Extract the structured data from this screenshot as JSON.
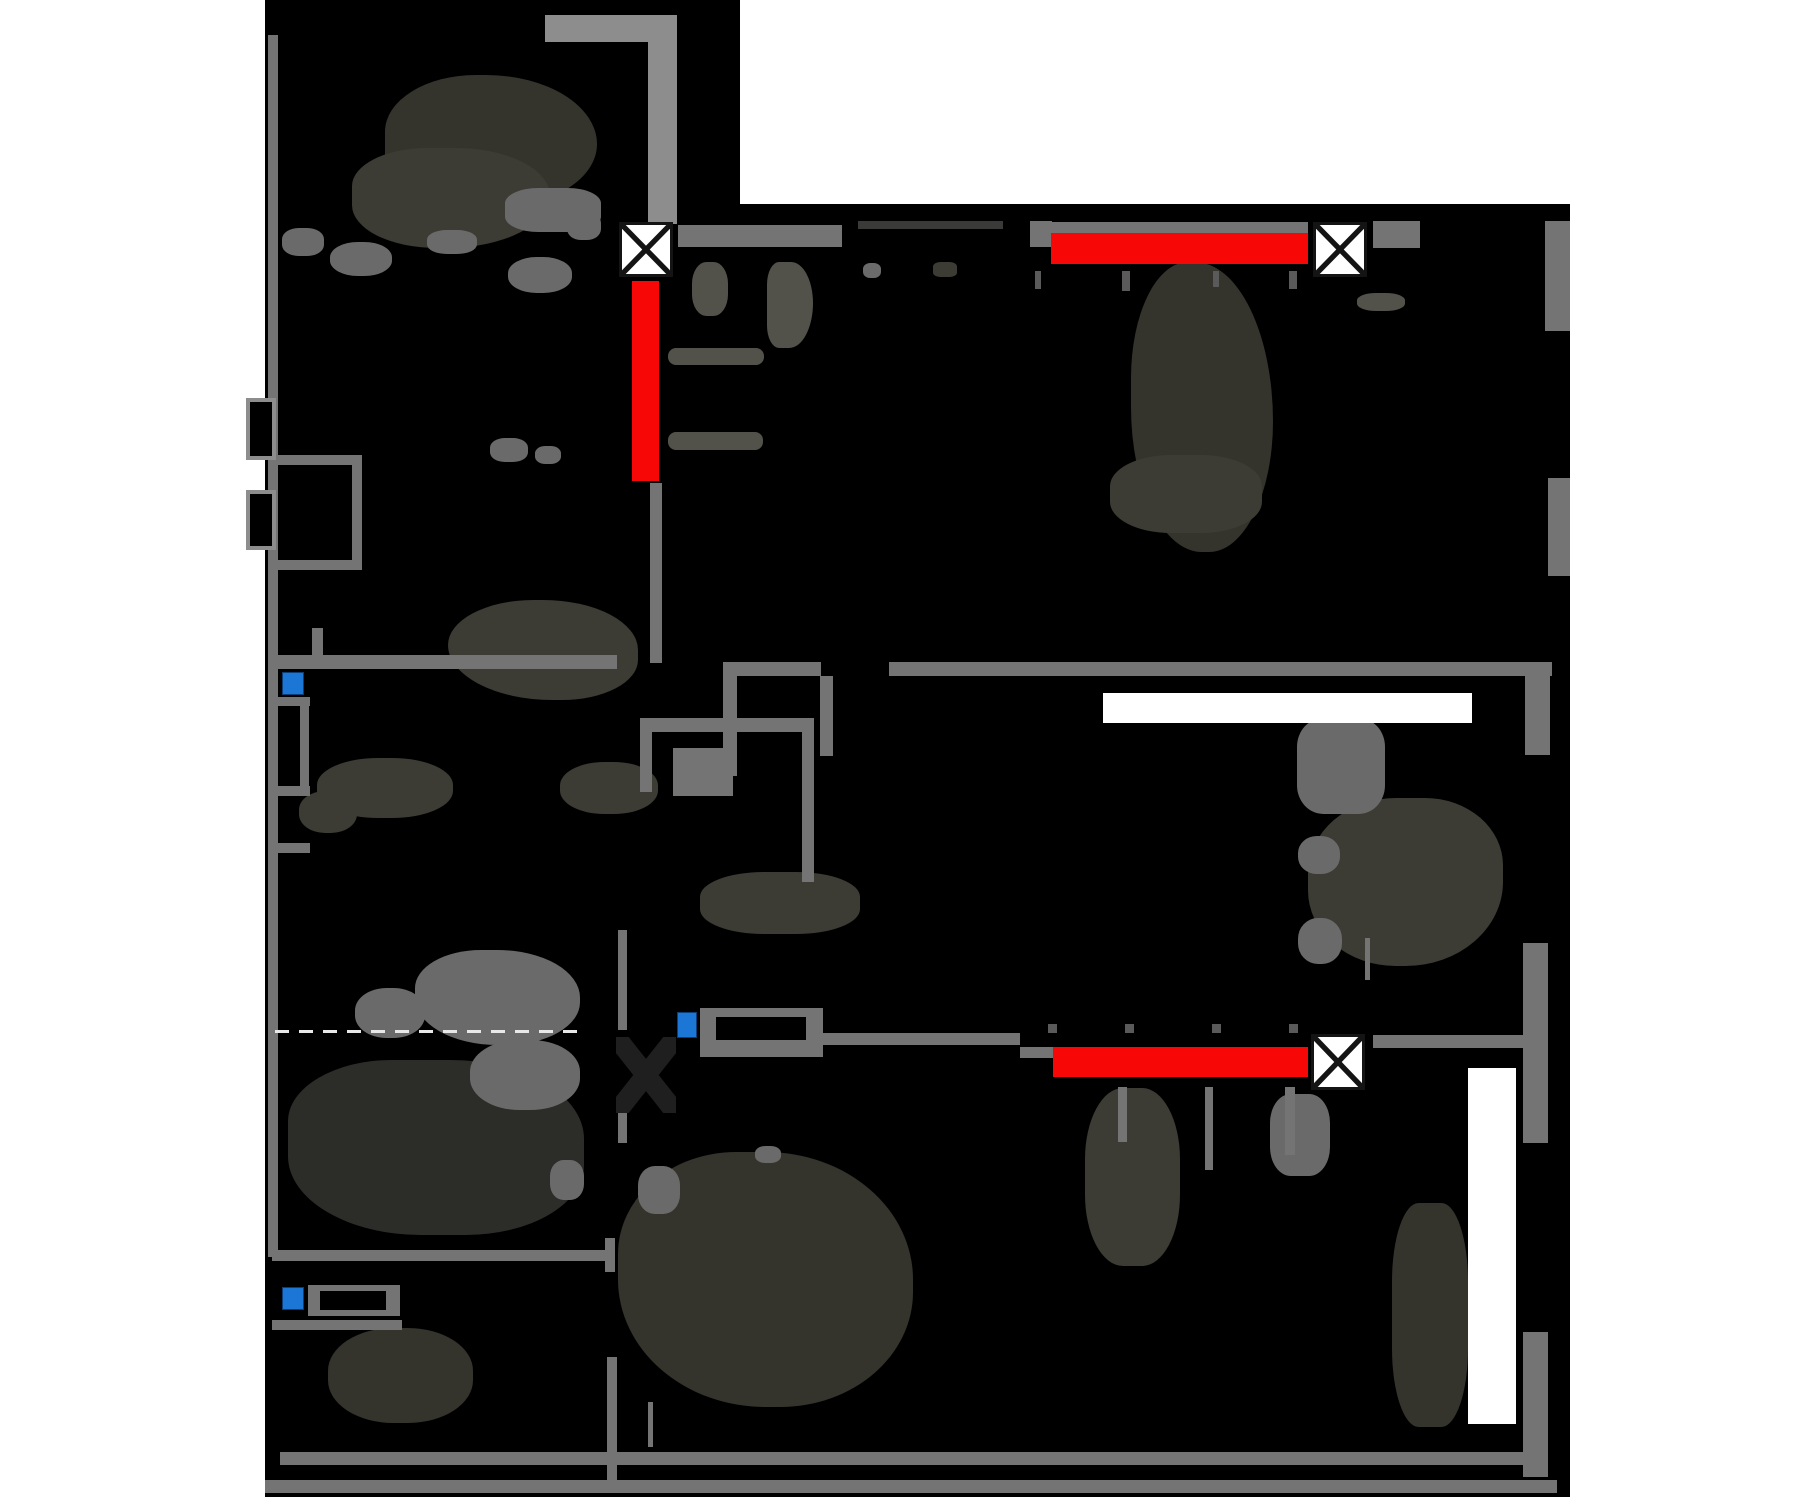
{
  "meta": {
    "width": 1800,
    "height": 1500,
    "background": "#ffffff",
    "plan_background": "#000000"
  },
  "labels": {
    "apartment_type": "3-комн."
  },
  "label_pos": {
    "x": 330,
    "y": 1122,
    "w": 200,
    "size": 36
  },
  "colors": {
    "wall": "#747474",
    "wall_light": "#8d8d8d",
    "wall_dark": "#3a3a38",
    "highlight_red": "#f80707",
    "highlight_white": "#ffffff",
    "marker_blue": "#1b76d6",
    "marker_blue_border": "#0b3e77",
    "vent_fill": "#ffffff",
    "vent_stroke": "#141414",
    "tick": "#5a5a5a",
    "dash": "#e8e8e8",
    "blob_dark1": "#2c2c28",
    "blob_dark2": "#34342d",
    "blob_dark3": "#3c3c34",
    "blob_mid": "#52524a",
    "blob_gray": "#6a6a6a"
  },
  "silhouette": [
    {
      "x": 265,
      "y": 0,
      "w": 475,
      "h": 1497
    },
    {
      "x": 738,
      "y": 204,
      "w": 832,
      "h": 1293
    }
  ],
  "walls": [
    {
      "x": 545,
      "y": 15,
      "w": 132,
      "h": 27,
      "c": "light"
    },
    {
      "x": 648,
      "y": 15,
      "w": 29,
      "h": 209,
      "c": "light"
    },
    {
      "x": 678,
      "y": 225,
      "w": 164,
      "h": 22
    },
    {
      "x": 858,
      "y": 221,
      "w": 145,
      "h": 8,
      "c": "dark"
    },
    {
      "x": 1030,
      "y": 221,
      "w": 22,
      "h": 26
    },
    {
      "x": 1035,
      "y": 222,
      "w": 273,
      "h": 11
    },
    {
      "x": 1373,
      "y": 221,
      "w": 47,
      "h": 27
    },
    {
      "x": 1545,
      "y": 221,
      "w": 25,
      "h": 110
    },
    {
      "x": 1548,
      "y": 478,
      "w": 22,
      "h": 98
    },
    {
      "x": 723,
      "y": 662,
      "w": 98,
      "h": 14
    },
    {
      "x": 889,
      "y": 662,
      "w": 663,
      "h": 14
    },
    {
      "x": 1525,
      "y": 662,
      "w": 25,
      "h": 93
    },
    {
      "x": 272,
      "y": 655,
      "w": 345,
      "h": 14
    },
    {
      "x": 268,
      "y": 35,
      "w": 10,
      "h": 1222
    },
    {
      "x": 650,
      "y": 483,
      "w": 12,
      "h": 180
    },
    {
      "x": 723,
      "y": 676,
      "w": 14,
      "h": 100
    },
    {
      "x": 820,
      "y": 676,
      "w": 13,
      "h": 80
    },
    {
      "x": 640,
      "y": 718,
      "w": 174,
      "h": 14
    },
    {
      "x": 802,
      "y": 732,
      "w": 12,
      "h": 150
    },
    {
      "x": 640,
      "y": 732,
      "w": 12,
      "h": 60
    },
    {
      "x": 618,
      "y": 930,
      "w": 9,
      "h": 100
    },
    {
      "x": 618,
      "y": 1098,
      "w": 9,
      "h": 45
    },
    {
      "x": 823,
      "y": 1033,
      "w": 197,
      "h": 12
    },
    {
      "x": 1020,
      "y": 1047,
      "w": 33,
      "h": 11
    },
    {
      "x": 1373,
      "y": 1035,
      "w": 150,
      "h": 13
    },
    {
      "x": 1523,
      "y": 943,
      "w": 25,
      "h": 200
    },
    {
      "x": 1523,
      "y": 1332,
      "w": 25,
      "h": 145
    },
    {
      "x": 1118,
      "y": 1087,
      "w": 9,
      "h": 55
    },
    {
      "x": 1205,
      "y": 1087,
      "w": 8,
      "h": 83
    },
    {
      "x": 1285,
      "y": 1087,
      "w": 10,
      "h": 68
    },
    {
      "x": 272,
      "y": 1250,
      "w": 335,
      "h": 11
    },
    {
      "x": 605,
      "y": 1238,
      "w": 10,
      "h": 34
    },
    {
      "x": 607,
      "y": 1357,
      "w": 10,
      "h": 133
    },
    {
      "x": 280,
      "y": 1452,
      "w": 1243,
      "h": 13
    },
    {
      "x": 265,
      "y": 1480,
      "w": 1292,
      "h": 13
    },
    {
      "x": 272,
      "y": 455,
      "w": 88,
      "h": 10
    },
    {
      "x": 272,
      "y": 560,
      "w": 88,
      "h": 10
    },
    {
      "x": 352,
      "y": 455,
      "w": 10,
      "h": 115
    },
    {
      "x": 272,
      "y": 1320,
      "w": 130,
      "h": 10
    },
    {
      "x": 312,
      "y": 628,
      "w": 11,
      "h": 30
    },
    {
      "x": 648,
      "y": 1402,
      "w": 5,
      "h": 45
    },
    {
      "x": 1365,
      "y": 938,
      "w": 5,
      "h": 42
    },
    {
      "x": 673,
      "y": 748,
      "w": 60,
      "h": 48
    },
    {
      "x": 270,
      "y": 697,
      "w": 40,
      "h": 9
    },
    {
      "x": 300,
      "y": 706,
      "w": 9,
      "h": 90
    },
    {
      "x": 272,
      "y": 786,
      "w": 38,
      "h": 10
    },
    {
      "x": 272,
      "y": 843,
      "w": 38,
      "h": 10
    }
  ],
  "shaft_boxes": [
    {
      "x": 246,
      "y": 398,
      "w": 30,
      "h": 62
    },
    {
      "x": 246,
      "y": 490,
      "w": 30,
      "h": 60
    }
  ],
  "red_bars": [
    {
      "x": 632,
      "y": 281,
      "w": 27,
      "h": 200
    },
    {
      "x": 1051,
      "y": 233,
      "w": 257,
      "h": 31
    },
    {
      "x": 1053,
      "y": 1047,
      "w": 255,
      "h": 30
    }
  ],
  "white_bars": [
    {
      "x": 1103,
      "y": 693,
      "w": 369,
      "h": 30
    },
    {
      "x": 1468,
      "y": 1068,
      "w": 48,
      "h": 356
    }
  ],
  "vent_boxes": [
    {
      "x": 619,
      "y": 222,
      "w": 54,
      "h": 55
    },
    {
      "x": 1313,
      "y": 222,
      "w": 54,
      "h": 55
    },
    {
      "x": 1311,
      "y": 1034,
      "w": 54,
      "h": 56
    }
  ],
  "dark_cross": {
    "x": 616,
    "y": 1037,
    "w": 60,
    "h": 76
  },
  "blue_markers": [
    {
      "x": 282,
      "y": 672,
      "w": 22,
      "h": 23
    },
    {
      "x": 677,
      "y": 1012,
      "w": 20,
      "h": 26
    },
    {
      "x": 282,
      "y": 1287,
      "w": 22,
      "h": 23
    }
  ],
  "counters": [
    {
      "x": 700,
      "y": 1008,
      "w": 123,
      "h": 49,
      "ix": 16,
      "iy": 9,
      "iw": 90,
      "ih": 23
    },
    {
      "x": 308,
      "y": 1285,
      "w": 92,
      "h": 31,
      "ix": 12,
      "iy": 6,
      "iw": 66,
      "ih": 19
    }
  ],
  "ticks": [
    {
      "x": 1035,
      "y": 271,
      "w": 6,
      "h": 18
    },
    {
      "x": 1122,
      "y": 271,
      "w": 8,
      "h": 20
    },
    {
      "x": 1213,
      "y": 271,
      "w": 6,
      "h": 16
    },
    {
      "x": 1289,
      "y": 271,
      "w": 8,
      "h": 18
    },
    {
      "x": 1048,
      "y": 1024,
      "w": 9,
      "h": 9
    },
    {
      "x": 1125,
      "y": 1024,
      "w": 9,
      "h": 9
    },
    {
      "x": 1212,
      "y": 1024,
      "w": 9,
      "h": 9
    },
    {
      "x": 1289,
      "y": 1024,
      "w": 9,
      "h": 9
    }
  ],
  "dashed_line": {
    "x": 275,
    "y": 1030,
    "w": 312,
    "h": 3
  },
  "blobs": [
    {
      "x": 385,
      "y": 75,
      "w": 212,
      "h": 132,
      "c": "blob_dark2",
      "r": "45% 55% 50% 40%"
    },
    {
      "x": 352,
      "y": 148,
      "w": 198,
      "h": 100,
      "c": "blob_dark3",
      "r": "40% 50% 55% 45%"
    },
    {
      "x": 282,
      "y": 228,
      "w": 42,
      "h": 28,
      "c": "blob_gray",
      "r": "40%"
    },
    {
      "x": 330,
      "y": 242,
      "w": 62,
      "h": 34,
      "c": "blob_gray",
      "r": "45%"
    },
    {
      "x": 427,
      "y": 230,
      "w": 50,
      "h": 24,
      "c": "blob_gray",
      "r": "40%"
    },
    {
      "x": 505,
      "y": 188,
      "w": 96,
      "h": 44,
      "c": "blob_gray",
      "r": "35%"
    },
    {
      "x": 508,
      "y": 257,
      "w": 64,
      "h": 36,
      "c": "blob_gray",
      "r": "45%"
    },
    {
      "x": 567,
      "y": 212,
      "w": 34,
      "h": 28,
      "c": "blob_gray",
      "r": "40%"
    },
    {
      "x": 692,
      "y": 262,
      "w": 36,
      "h": 54,
      "c": "blob_mid",
      "r": "40%"
    },
    {
      "x": 767,
      "y": 262,
      "w": 46,
      "h": 86,
      "c": "blob_mid",
      "r": "30% 55% 60% 30%"
    },
    {
      "x": 668,
      "y": 348,
      "w": 96,
      "h": 17,
      "c": "blob_mid",
      "r": "8px"
    },
    {
      "x": 668,
      "y": 432,
      "w": 95,
      "h": 18,
      "c": "blob_mid",
      "r": "8px"
    },
    {
      "x": 863,
      "y": 263,
      "w": 18,
      "h": 15,
      "c": "blob_gray",
      "r": "40%"
    },
    {
      "x": 933,
      "y": 262,
      "w": 24,
      "h": 15,
      "c": "blob_dark3",
      "r": "30%"
    },
    {
      "x": 490,
      "y": 438,
      "w": 38,
      "h": 24,
      "c": "blob_gray",
      "r": "40%"
    },
    {
      "x": 535,
      "y": 446,
      "w": 26,
      "h": 18,
      "c": "blob_gray",
      "r": "40%"
    },
    {
      "x": 448,
      "y": 600,
      "w": 190,
      "h": 100,
      "c": "blob_dark3",
      "r": "45% 50% 40% 55%"
    },
    {
      "x": 317,
      "y": 758,
      "w": 136,
      "h": 60,
      "c": "blob_dark3",
      "r": "45%"
    },
    {
      "x": 299,
      "y": 791,
      "w": 58,
      "h": 42,
      "c": "blob_dark3",
      "r": "45%"
    },
    {
      "x": 560,
      "y": 762,
      "w": 98,
      "h": 52,
      "c": "blob_dark3",
      "r": "45%"
    },
    {
      "x": 700,
      "y": 872,
      "w": 160,
      "h": 62,
      "c": "blob_dark3",
      "r": "40%"
    },
    {
      "x": 288,
      "y": 1060,
      "w": 296,
      "h": 175,
      "c": "blob_dark1",
      "r": "35% 45% 40% 45%"
    },
    {
      "x": 415,
      "y": 950,
      "w": 165,
      "h": 95,
      "c": "blob_gray",
      "r": "40% 50% 45% 50%"
    },
    {
      "x": 355,
      "y": 988,
      "w": 70,
      "h": 50,
      "c": "blob_gray",
      "r": "45%"
    },
    {
      "x": 470,
      "y": 1040,
      "w": 110,
      "h": 70,
      "c": "blob_gray",
      "r": "45%"
    },
    {
      "x": 328,
      "y": 1328,
      "w": 145,
      "h": 95,
      "c": "blob_dark2",
      "r": "45%"
    },
    {
      "x": 618,
      "y": 1152,
      "w": 295,
      "h": 255,
      "c": "blob_dark2",
      "r": "40% 50% 45% 50%"
    },
    {
      "x": 638,
      "y": 1166,
      "w": 42,
      "h": 48,
      "c": "blob_gray",
      "r": "40%"
    },
    {
      "x": 550,
      "y": 1160,
      "w": 34,
      "h": 40,
      "c": "blob_gray",
      "r": "40%"
    },
    {
      "x": 755,
      "y": 1146,
      "w": 26,
      "h": 17,
      "c": "blob_gray",
      "r": "40%"
    },
    {
      "x": 1085,
      "y": 1088,
      "w": 95,
      "h": 178,
      "c": "blob_dark3",
      "r": "40%"
    },
    {
      "x": 1270,
      "y": 1094,
      "w": 60,
      "h": 82,
      "c": "blob_gray",
      "r": "35%"
    },
    {
      "x": 1131,
      "y": 262,
      "w": 142,
      "h": 290,
      "c": "blob_dark2",
      "r": "40% 55% 45% 50%"
    },
    {
      "x": 1110,
      "y": 455,
      "w": 152,
      "h": 78,
      "c": "blob_dark3",
      "r": "40%"
    },
    {
      "x": 1357,
      "y": 293,
      "w": 48,
      "h": 18,
      "c": "blob_mid",
      "r": "40%"
    },
    {
      "x": 1308,
      "y": 798,
      "w": 195,
      "h": 168,
      "c": "blob_dark3",
      "r": "45% 40% 50% 45%"
    },
    {
      "x": 1297,
      "y": 718,
      "w": 88,
      "h": 96,
      "c": "blob_gray",
      "r": "30%"
    },
    {
      "x": 1298,
      "y": 836,
      "w": 42,
      "h": 38,
      "c": "blob_gray",
      "r": "45%"
    },
    {
      "x": 1298,
      "y": 918,
      "w": 44,
      "h": 46,
      "c": "blob_gray",
      "r": "45%"
    },
    {
      "x": 1392,
      "y": 1203,
      "w": 76,
      "h": 224,
      "c": "blob_dark2",
      "r": "35%"
    }
  ]
}
